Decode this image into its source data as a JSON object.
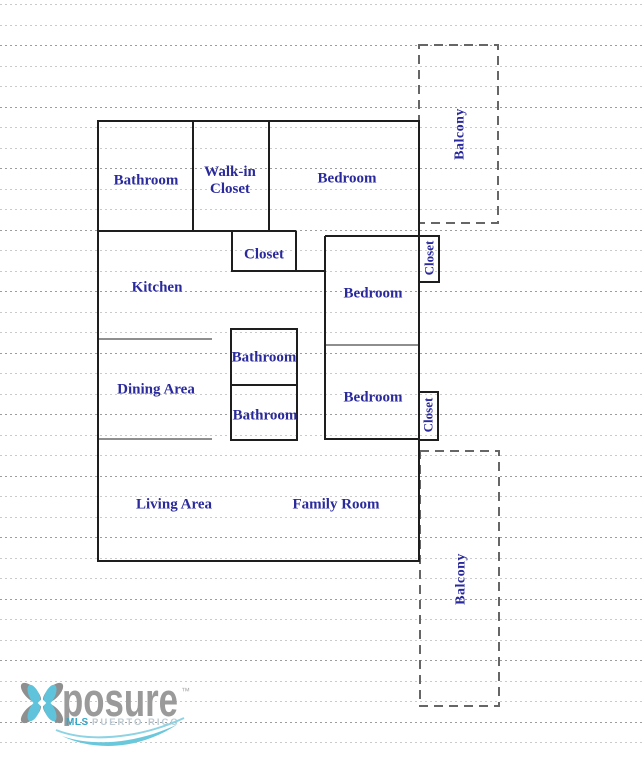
{
  "rooms": {
    "bathroom_main": "Bathroom",
    "walk_in_closet_line1": "Walk-in",
    "walk_in_closet_line2": "Closet",
    "bedroom_top": "Bedroom",
    "closet_hall": "Closet",
    "kitchen": "Kitchen",
    "bedroom_mid": "Bedroom",
    "bathroom_upper": "Bathroom",
    "dining": "Dining Area",
    "bathroom_lower": "Bathroom",
    "bedroom_lower": "Bedroom",
    "living": "Living Area",
    "family": "Family Room",
    "closet_side_top": "Closet",
    "closet_side_bottom": "Closet",
    "balcony_top": "Balcony",
    "balcony_bottom": "Balcony"
  },
  "watermark": {
    "brand": "posure",
    "trademark": "™",
    "mls": "MLS",
    "region": "PUERTO RICO"
  },
  "colors": {
    "room_text": "#2A2A9D",
    "wall": "#1E1E1E",
    "balcony_dash": "#666666",
    "rule_line": "#B9B9B9",
    "logo_gray": "#9A9A9A",
    "logo_light_blue": "#6AC8DC",
    "logo_teal": "#35A7C9"
  }
}
